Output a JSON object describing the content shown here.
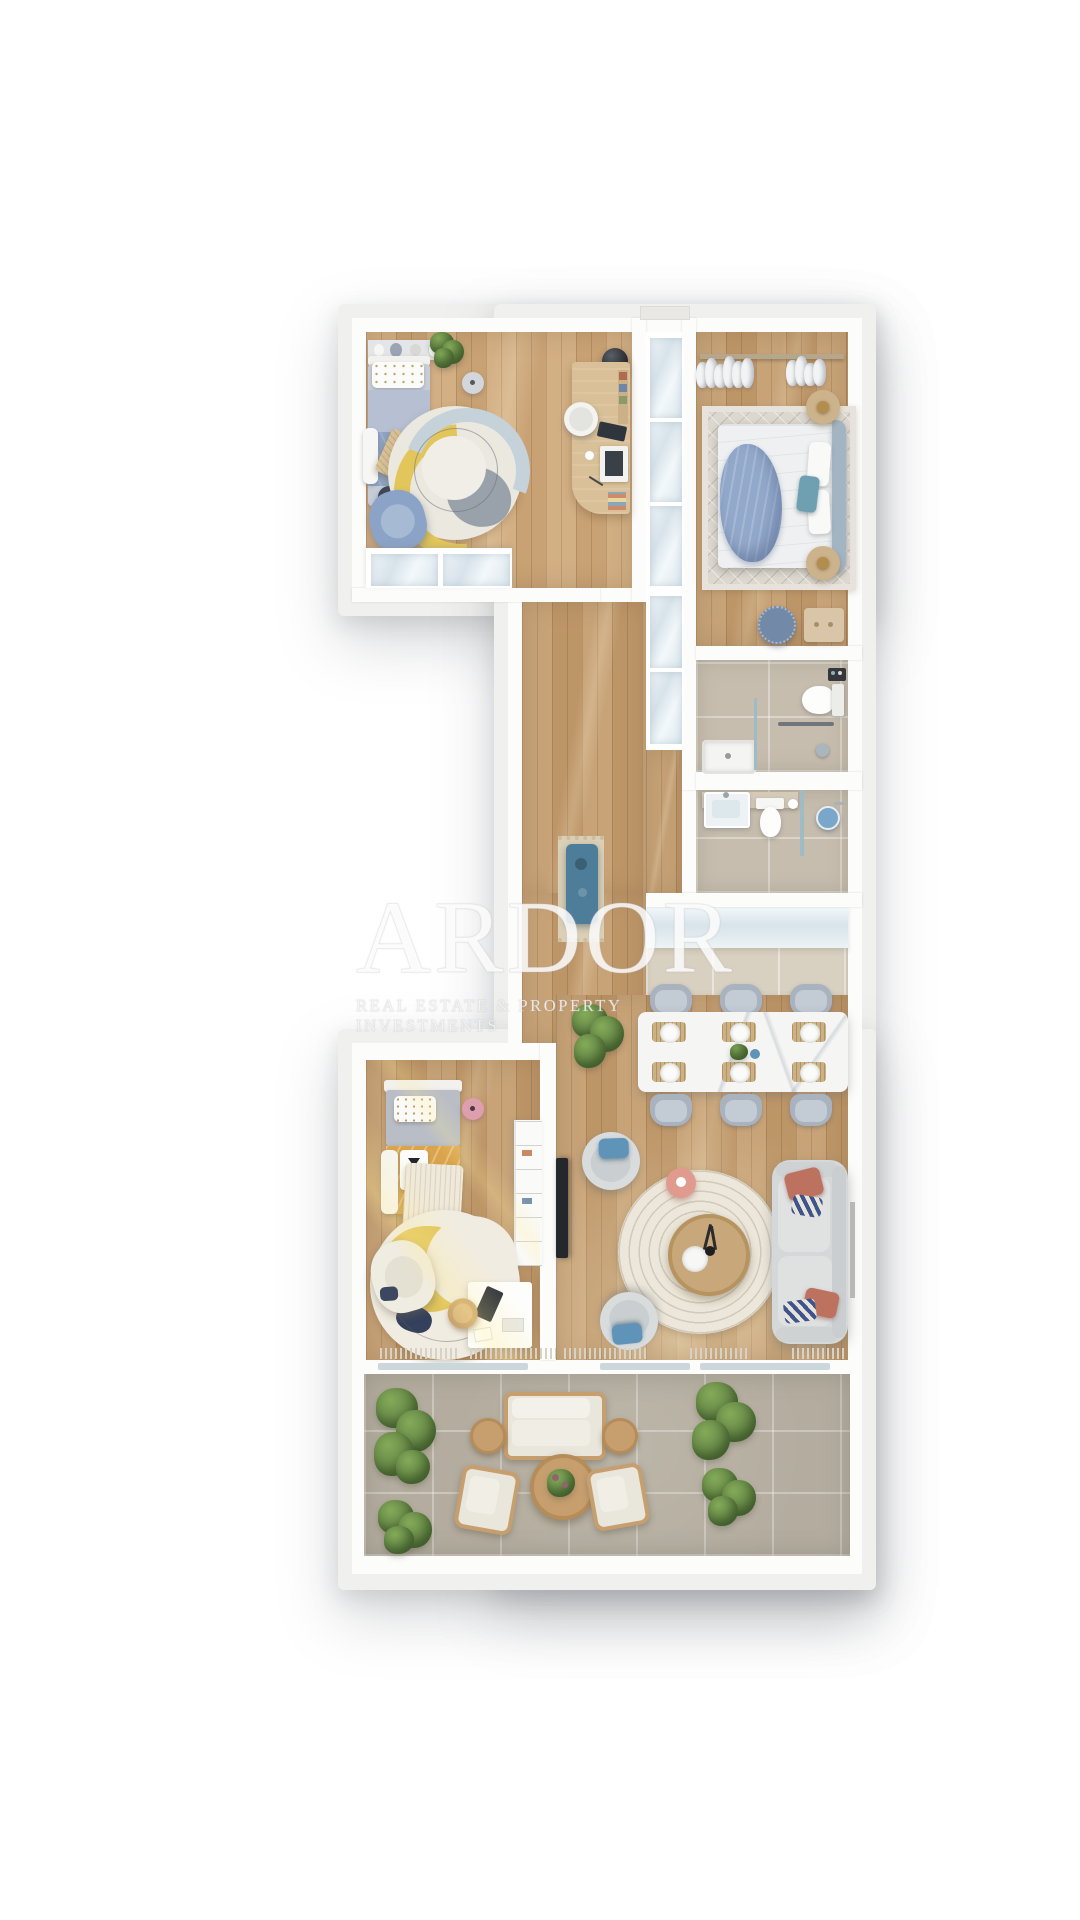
{
  "watermark": {
    "title": "ARDOR",
    "subtitle": "REAL ESTATE & PROPERTY INVESTMENTS"
  },
  "palette": {
    "page_bg": "#ffffff",
    "frame": "#f0f0ee",
    "wall": "#fcfcfb",
    "wood": "#c49c6e",
    "wood_light": "#d0a97b",
    "bath_tile": "#c6bdae",
    "terrace_tile": "#b4ad9f",
    "kitchen_floor": "#d8d0c0",
    "frosted_glass": "#9fbcc6",
    "counter_gloss": "#dce8ed",
    "teal_console": "#4e7d99",
    "kids_bed_blue": "#8ea4c4",
    "kids_rug_yellow": "#e2c65c",
    "master_blanket_blue": "#93a9cb",
    "mustard_bed": "#d9a44c",
    "pink_accent": "#dd9fae",
    "coral_table": "#e09a8e",
    "terracotta_pillow": "#bd7260",
    "navy": "#34405c",
    "sofa_gray": "#d5d8d9",
    "dining_chair": "#a9b3bf",
    "plant_green": "#5d7d42",
    "plant_green_light": "#83aa58",
    "outdoor_wood": "#c79f6f",
    "watermark_color": "rgba(255,255,255,0.82)"
  }
}
